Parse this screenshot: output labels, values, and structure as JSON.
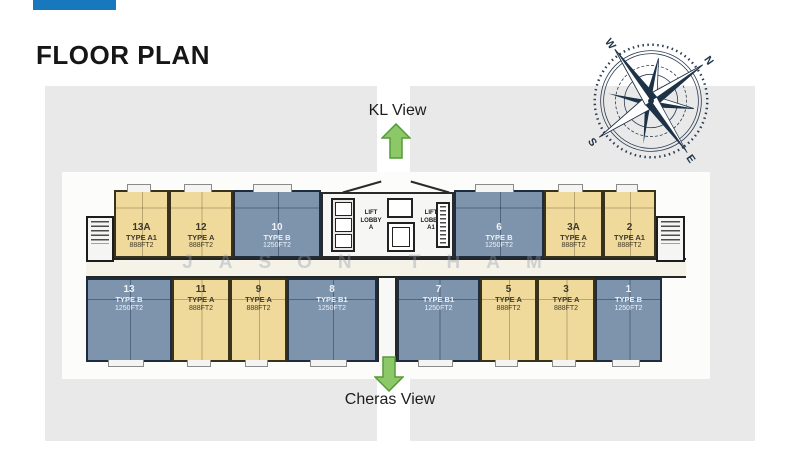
{
  "slide": {
    "title": "FLOOR PLAN"
  },
  "brand": {
    "logo_color": "#1878be"
  },
  "views": {
    "top_label": "KL View",
    "bottom_label": "Cheras View"
  },
  "watermark": "JASON THAM",
  "compass": {
    "n": "N",
    "e": "E",
    "s": "S",
    "w": "W"
  },
  "lobby": {
    "a": "LIFT\nLOBBY\nA",
    "a1": "LIFT\nLOBBY\nA1"
  },
  "colors": {
    "type_a_fill": "#efd99b",
    "type_b_fill": "#7e94ad",
    "arrow_green": "#8cc868",
    "background_gray": "#e9e9e9",
    "wall_dark": "#262626",
    "compass_navy": "#1e3247"
  },
  "units": {
    "top": [
      {
        "no": "13A",
        "type": "TYPE A1",
        "area": "888FT2"
      },
      {
        "no": "12",
        "type": "TYPE A",
        "area": "888FT2"
      },
      {
        "no": "10",
        "type": "TYPE B",
        "area": "1250FT2"
      },
      {
        "no": "6",
        "type": "TYPE B",
        "area": "1250FT2"
      },
      {
        "no": "3A",
        "type": "TYPE A",
        "area": "888FT2"
      },
      {
        "no": "2",
        "type": "TYPE A1",
        "area": "888FT2"
      }
    ],
    "bottom": [
      {
        "no": "13",
        "type": "TYPE B",
        "area": "1250FT2"
      },
      {
        "no": "11",
        "type": "TYPE A",
        "area": "888FT2"
      },
      {
        "no": "9",
        "type": "TYPE A",
        "area": "888FT2"
      },
      {
        "no": "8",
        "type": "TYPE B1",
        "area": "1250FT2"
      },
      {
        "no": "7",
        "type": "TYPE B1",
        "area": "1250FT2"
      },
      {
        "no": "5",
        "type": "TYPE A",
        "area": "888FT2"
      },
      {
        "no": "3",
        "type": "TYPE A",
        "area": "888FT2"
      },
      {
        "no": "1",
        "type": "TYPE B",
        "area": "1250FT2"
      }
    ]
  }
}
